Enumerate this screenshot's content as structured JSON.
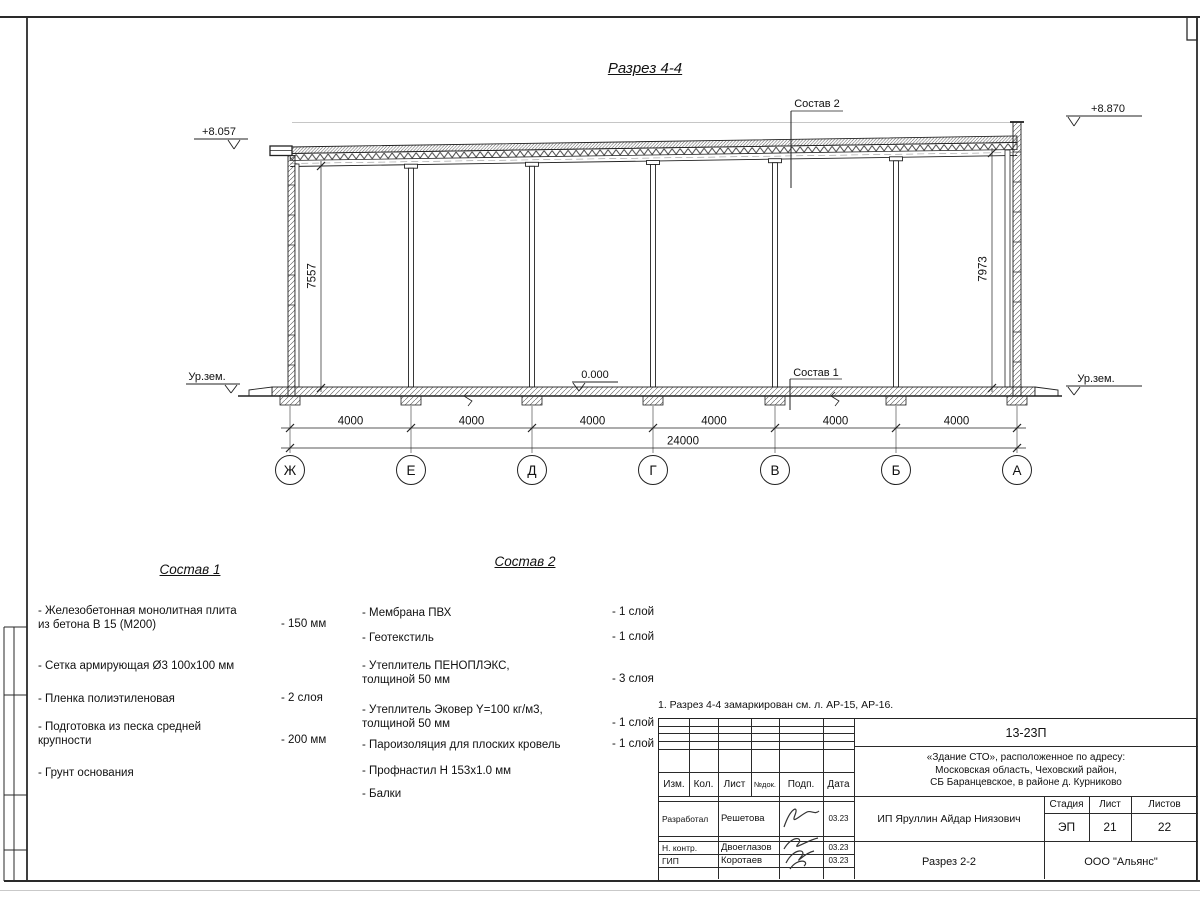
{
  "page": {
    "section_title": "Разрез 4-4",
    "note": "1. Разрез 4-4 замаркирован см. л. АР-15, АР-16."
  },
  "drawing": {
    "elev_left": "+8.057",
    "elev_right": "+8.870",
    "elev_zero": "0.000",
    "ground_left": "Ур.зем.",
    "ground_right": "Ур.зем.",
    "vdim_left": "7557",
    "vdim_right": "7973",
    "axes": [
      "Ж",
      "Е",
      "Д",
      "Г",
      "В",
      "Б",
      "А"
    ],
    "bays": [
      "4000",
      "4000",
      "4000",
      "4000",
      "4000",
      "4000"
    ],
    "total": "24000",
    "callout1": "Состав 1",
    "callout2": "Состав 2"
  },
  "sostav1": {
    "title": "Состав 1",
    "items": [
      {
        "name": "- Железобетонная  монолитная плита\nиз бетона В 15 (М200)",
        "value": "- 150 мм"
      },
      {
        "name": "- Сетка армирующая Ø3 100х100 мм",
        "value": ""
      },
      {
        "name": "- Пленка полиэтиленовая",
        "value": "-  2 слоя"
      },
      {
        "name": "- Подготовка из песка средней\nкрупности",
        "value": "- 200 мм"
      },
      {
        "name": "- Грунт основания",
        "value": ""
      }
    ]
  },
  "sostav2": {
    "title": "Состав 2",
    "items": [
      {
        "name": "- Мембрана ПВХ",
        "value": "- 1 слой"
      },
      {
        "name": "- Геотекстиль",
        "value": "- 1 слой"
      },
      {
        "name": "- Утеплитель ПЕНОПЛЭКС,\nтолщиной 50 мм",
        "value": "- 3 слоя"
      },
      {
        "name": "- Утеплитель Эковер Y=100 кг/м3,\nтолщиной 50 мм",
        "value": "- 1 слой"
      },
      {
        "name": "- Пароизоляция для плоских кровель",
        "value": "- 1 слой"
      },
      {
        "name": "- Профнастил Н 153х1.0 мм",
        "value": ""
      },
      {
        "name": "- Балки",
        "value": ""
      }
    ]
  },
  "titleblock": {
    "doc_number": "13-23П",
    "project": "«Здание СТО», расположенное по адресу:\nМосковская область, Чеховский район,\nСБ Баранцевское, в районе д. Курниково",
    "client": "ИП Яруллин Айдар Ниязович",
    "stage_label": "Стадия",
    "sheet_label": "Лист",
    "sheets_label": "Листов",
    "stage": "ЭП",
    "sheet": "21",
    "sheets": "22",
    "sheet_title": "Разрез 2-2",
    "company": "ООО \"Альянс\"",
    "col_izm": "Изм.",
    "col_kol": "Кол.",
    "col_list": "Лист",
    "col_ndoc": "№док.",
    "col_podp": "Подп.",
    "col_data": "Дата",
    "rows": [
      {
        "role": "Разработал",
        "name": "Решетова",
        "date": "03.23"
      },
      {
        "role": "Н. контр.",
        "name": "Двоеглазов",
        "date": "03.23"
      },
      {
        "role": "ГИП",
        "name": "Коротаев",
        "date": "03.23"
      }
    ]
  }
}
